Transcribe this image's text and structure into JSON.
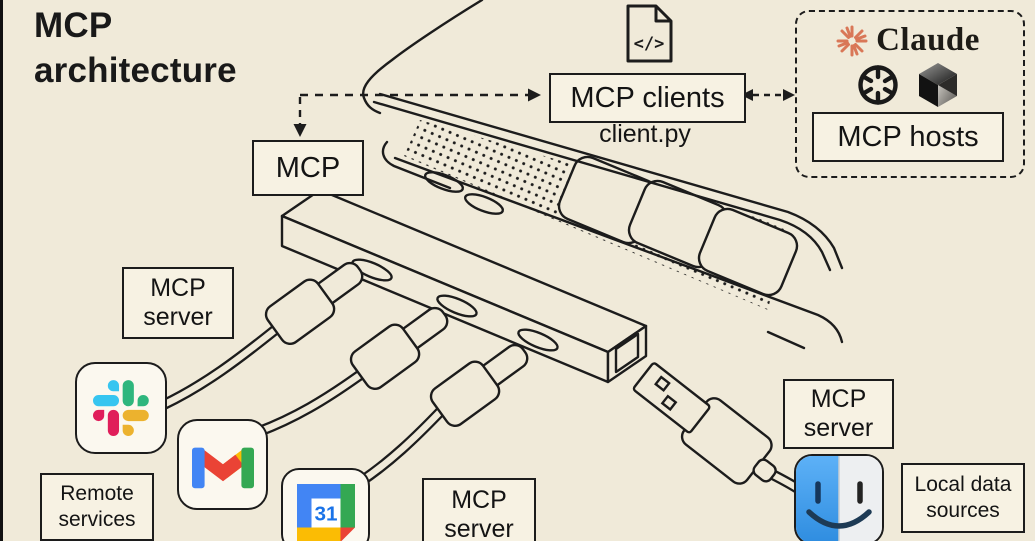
{
  "title": "MCP architecture",
  "nodes": {
    "mcp": {
      "label": "MCP"
    },
    "mcp_clients": {
      "label": "MCP clients",
      "file": "client.py"
    },
    "mcp_hosts": {
      "label": "MCP hosts",
      "brand": "Claude"
    },
    "server_remote": {
      "line1": "MCP",
      "line2": "server"
    },
    "server_middle": {
      "line1": "MCP",
      "line2": "server"
    },
    "server_local": {
      "line1": "MCP",
      "line2": "server"
    },
    "remote_services": {
      "line1": "Remote",
      "line2": "services"
    },
    "local_sources": {
      "line1": "Local data",
      "line2": "sources"
    }
  },
  "icons": {
    "code_file_glyph": "</>",
    "calendar_day": "31",
    "names": [
      "code-file-icon",
      "claude-starburst-icon",
      "openai-icon",
      "cursor-cube-icon",
      "slack-icon",
      "gmail-icon",
      "google-calendar-icon",
      "finder-icon"
    ]
  },
  "colors": {
    "background": "#f0ead9",
    "line": "#1c1c1c",
    "box_fill": "#f7f2e3",
    "claude_orange": "#d97757",
    "slack_blue": "#36C5F0",
    "slack_green": "#2EB67D",
    "slack_yellow": "#ECB22E",
    "slack_red": "#E01E5A",
    "google_blue": "#4285F4",
    "google_red": "#EA4335",
    "google_yellow": "#FBBC04",
    "google_green": "#34A853",
    "calendar_blue": "#1a73e8",
    "finder_blue": "#4aa3ef"
  }
}
